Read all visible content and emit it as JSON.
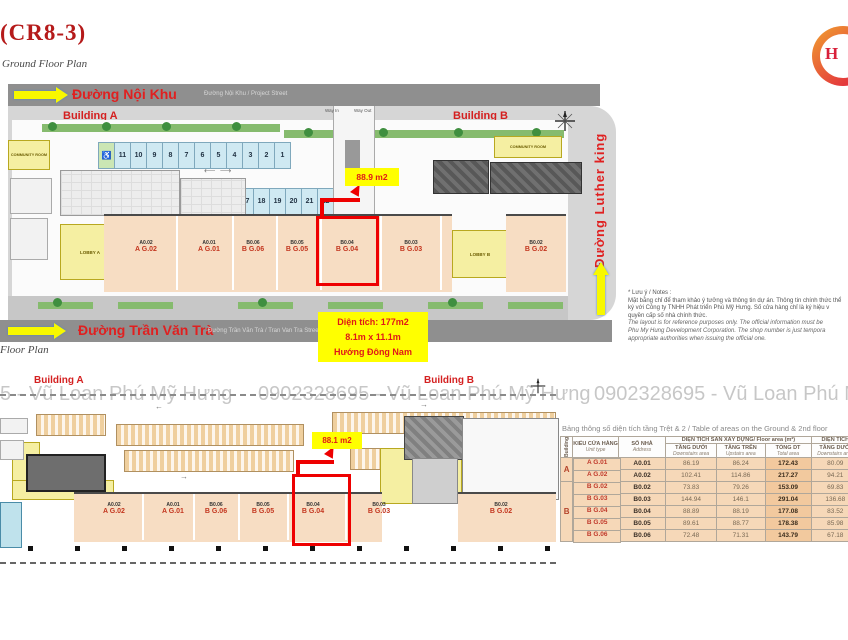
{
  "header": {
    "project_code": "(CR8-3)",
    "plan_label": "Ground Floor Plan",
    "plan_label_2": "Floor Plan"
  },
  "logo": {
    "letter": "H"
  },
  "roads": {
    "top": {
      "name": "Đường Nội Khu",
      "subtitle": "Đường Nội Khu / Project Street"
    },
    "bottom": {
      "name": "Đường Trần Văn Trà",
      "subtitle": "Đường Trần Văn Trà / Tran Van Tra Street"
    },
    "right": {
      "name": "Đường Luther king"
    }
  },
  "ground_plan": {
    "building_a": "Building A",
    "building_b": "Building B",
    "community_room": "COMMUNITY ROOM",
    "community_room_right": "COMMUNITY ROOM",
    "lobby_a": "LOBBY A",
    "lobby_b": "LOBBY B",
    "way_in": "Way In",
    "way_out": "Way Out",
    "parking_row1": [
      "♿",
      "11",
      "10",
      "9",
      "8",
      "7",
      "6",
      "5",
      "4",
      "3",
      "2",
      "1"
    ],
    "parking_row2": [
      "12",
      "13",
      "14",
      "♿",
      "15",
      "16",
      "17",
      "18",
      "19",
      "20",
      "21",
      "22",
      "23",
      "♿"
    ],
    "area_callout": "88.9 m2"
  },
  "second_plan": {
    "building_a": "Building A",
    "building_b": "Building B",
    "area_callout": "88.1 m2"
  },
  "units": [
    {
      "code": "A0.02",
      "name": "A G.02"
    },
    {
      "code": "A0.01",
      "name": "A G.01"
    },
    {
      "code": "B0.06",
      "name": "B G.06"
    },
    {
      "code": "B0.05",
      "name": "B G.05"
    },
    {
      "code": "B0.04",
      "name": "B G.04"
    },
    {
      "code": "B0.03",
      "name": "B G.03"
    },
    {
      "code": "B0.02",
      "name": "B G.02"
    }
  ],
  "annotation": {
    "line1": "Diện tích: 177m2",
    "line2": "8.1m x 11.1m",
    "line3": "Hướng Đông Nam"
  },
  "watermarks": {
    "left": "5 - Vũ Loan Phú Mỹ Hưng",
    "center": "0902328695 - Vũ Loan Phú Mỹ Hưng",
    "right": "0902328695 - Vũ Loan Phú M"
  },
  "notes": {
    "lines": [
      "* Lưu ý / Notes :",
      "Mặt bằng chỉ để tham khảo ý tưởng và thông tin dự án. Thông tin chính thức thể",
      "ký với Công ty TNHH Phát triển Phú Mỹ Hưng. Số cửa hàng chỉ là ký hiệu v",
      "quyền cấp số nhà chính thức.",
      "The layout is for reference purposes only. The official information must be",
      "Phu My Hung Development Corporation. The shop number is just tempora",
      "appropriate authorities when issuing the official one."
    ]
  },
  "table": {
    "title": "Bảng thông số diện tích tầng Trệt & 2 / Table of areas on the Ground & 2nd floor",
    "headers": {
      "building": "Building",
      "unit_vn": "KIỂU CỬA HÀNG",
      "unit_en": "Unit type",
      "addr_vn": "SỐ NHÀ",
      "addr_en": "Address",
      "group1": "DIỆN TÍCH SÀN XÂY DỰNG/ Floor area (m²)",
      "down_vn": "TẦNG DƯỚI",
      "down_en": "Downstairs area",
      "up_vn": "TẦNG TRÊN",
      "up_en": "Upstairs area",
      "total_vn": "TỔNG DT",
      "total_en": "Total area",
      "group2": "DIỆN TÍCH",
      "down2_vn": "TẦNG DƯỚI",
      "down2_en": "Downstairs area"
    },
    "groups": [
      {
        "building": "A",
        "rows": [
          {
            "unit": "A G.01",
            "addr": "A0.01",
            "down": "86.19",
            "up": "86.24",
            "total": "172.43",
            "down2": "80.09"
          },
          {
            "unit": "A G.02",
            "addr": "A0.02",
            "down": "102.41",
            "up": "114.86",
            "total": "217.27",
            "down2": "94.21"
          }
        ]
      },
      {
        "building": "B",
        "rows": [
          {
            "unit": "B G.02",
            "addr": "B0.02",
            "down": "73.83",
            "up": "79.26",
            "total": "153.09",
            "down2": "69.83"
          },
          {
            "unit": "B G.03",
            "addr": "B0.03",
            "down": "144.94",
            "up": "146.1",
            "total": "291.04",
            "down2": "136.68"
          },
          {
            "unit": "B G.04",
            "addr": "B0.04",
            "down": "88.89",
            "up": "88.19",
            "total": "177.08",
            "down2": "83.52"
          },
          {
            "unit": "B G.05",
            "addr": "B0.05",
            "down": "89.61",
            "up": "88.77",
            "total": "178.38",
            "down2": "85.98"
          },
          {
            "unit": "B G.06",
            "addr": "B0.06",
            "down": "72.48",
            "up": "71.31",
            "total": "143.79",
            "down2": "67.18"
          }
        ]
      }
    ]
  },
  "colors": {
    "accent_red": "#e02020",
    "highlight_yellow": "#ffff00",
    "stall_blue": "#cfe9f2",
    "unit_tan": "#f7ddc3"
  }
}
